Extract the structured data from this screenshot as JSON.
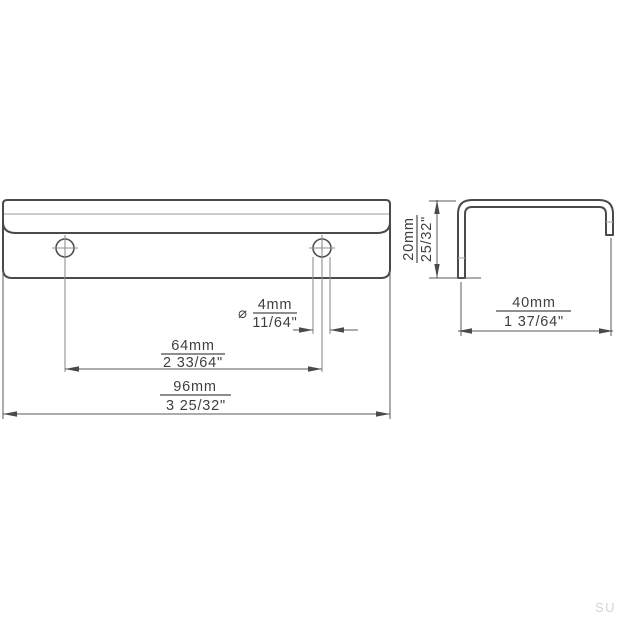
{
  "drawing": {
    "kind": "furniture-handle-technical-drawing",
    "views": {
      "front": "front view of edge pull with two mounting holes",
      "side": "side profile view of edge pull"
    },
    "dimensions": {
      "hole_diameter": {
        "symbol": "⌀",
        "mm": "4mm",
        "inch": "11/64\""
      },
      "hole_spacing": {
        "mm": "64mm",
        "inch": "2 33/64\""
      },
      "length": {
        "mm": "96mm",
        "inch": "3 25/32\""
      },
      "height": {
        "mm": "20mm",
        "inch": "25/32\""
      },
      "depth": {
        "mm": "40mm",
        "inch": "1 37/64\""
      }
    },
    "watermark": "SU"
  },
  "colors": {
    "background": "#ffffff",
    "outline": "#4a4a4a",
    "dimension_line": "#585858",
    "light_line": "#bcbcbc",
    "center_line": "#8f8f8f",
    "watermark": "#d4d4d4"
  }
}
